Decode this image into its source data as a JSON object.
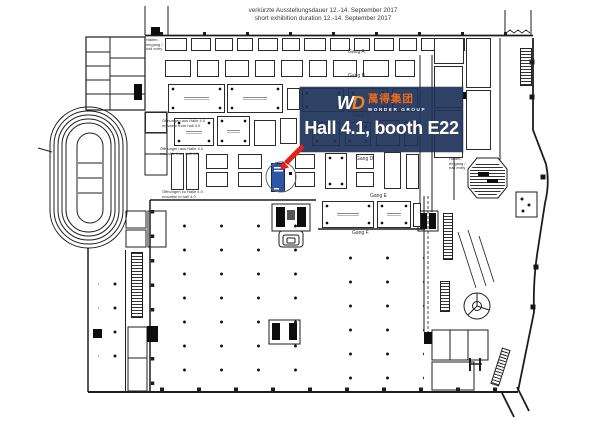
{
  "header": {
    "duration_de": "verkürzte Ausstellungsdauer 12.-14. September 2017",
    "duration_en": "short exhibition duration 12.-14. September 2017"
  },
  "callout": {
    "logo_w": "W",
    "logo_d": "D",
    "logo_cn": "萬得集团",
    "logo_group": "WONDER GROUP",
    "text": "Hall 4.1, booth E22"
  },
  "map": {
    "aisles": [
      {
        "label": "Gang A"
      },
      {
        "label": "Gang B"
      },
      {
        "label": "Gang C"
      },
      {
        "label": "Gang D"
      },
      {
        "label": "Gang E"
      },
      {
        "label": "Gang F"
      }
    ],
    "entries": [
      {
        "text": "Hallen-eingang / hall entry"
      },
      {
        "text": "Hallen-eingang / hall entry"
      }
    ],
    "notes": [
      {
        "text": "Öffnungen aus Halle 4.0 movable from hall 4.0"
      },
      {
        "text": "Öffnungen aus Halle 4.0 movable from hall 4.0"
      },
      {
        "text": "Öffnungen zu Halle 4.0 movable to hall 4.0"
      }
    ]
  },
  "colors": {
    "overlay_navy": "#20335a",
    "brand_orange": "#f5821f",
    "arrow_red": "#e32119",
    "booth_blue": "#2d56a5"
  }
}
